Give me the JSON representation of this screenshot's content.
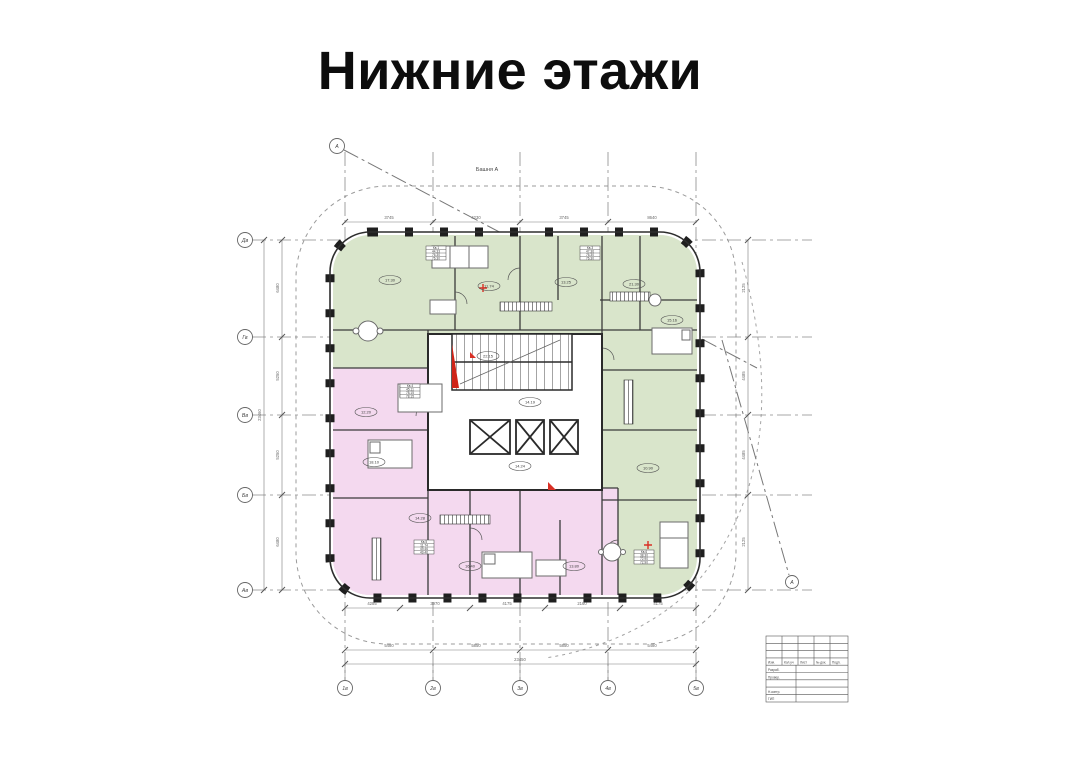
{
  "page": {
    "title": "Нижние этажи"
  },
  "drawing": {
    "tower_label": "Башня А",
    "colors": {
      "zone_green": "#d9e5cb",
      "zone_pink": "#f4d9ef",
      "wall": "#2e2e2e",
      "grid_line": "#8a8a8a",
      "dimension_line": "#777777",
      "accent_red": "#d93025"
    },
    "grid": {
      "left_axes": [
        "Дв",
        "Гв",
        "Вв",
        "Бв",
        "Ав"
      ],
      "bottom_axes": [
        "1в",
        "2в",
        "3в",
        "4в",
        "5в"
      ],
      "section_marker": "А"
    },
    "dimensions": {
      "approximate": true,
      "left_chain": [
        "6480",
        "5250",
        "5250",
        "6480"
      ],
      "left_total": "23460",
      "right_chain": [
        "2125",
        "4485",
        "4485",
        "2125"
      ],
      "top_chain": [
        "3745",
        "4230",
        "3745",
        "8640"
      ],
      "bottom_inner_chain": [
        "4285",
        "3970",
        "4175",
        "2160",
        "4175"
      ],
      "bottom_chain": [
        "5480",
        "5850",
        "5850",
        "5480"
      ],
      "bottom_total": "23450"
    },
    "room_areas": [
      "17.30",
      "11.74",
      "13.25",
      "21.30",
      "14.19",
      "15.16",
      "12.20",
      "18.10",
      "14.28",
      "16.40",
      "13.80",
      "10.90",
      "14.24",
      "22.15"
    ],
    "apartment_stamps": [
      {
        "name": "Кв.1",
        "rows": [
          "44.33",
          "76.30",
          "76.30"
        ]
      },
      {
        "name": "Кв.3",
        "rows": [
          "47.36",
          "76.30",
          "76.30"
        ]
      },
      {
        "name": "Кв.4",
        "rows": [
          "45.11",
          "78.15",
          "78.15"
        ]
      },
      {
        "name": "Кв.5",
        "rows": [
          "11.74",
          "49.46",
          "49.46"
        ]
      },
      {
        "name": "Кв.6",
        "rows": [
          "38.30",
          "72.90",
          "72.90"
        ]
      }
    ],
    "title_block": {
      "header_cells": [
        "Изм.",
        "Кол.уч",
        "Лист",
        "№ док.",
        "Подп."
      ],
      "lower_rows": [
        "Разраб.",
        "Провер.",
        "Н.контр.",
        "ГИП"
      ]
    }
  }
}
